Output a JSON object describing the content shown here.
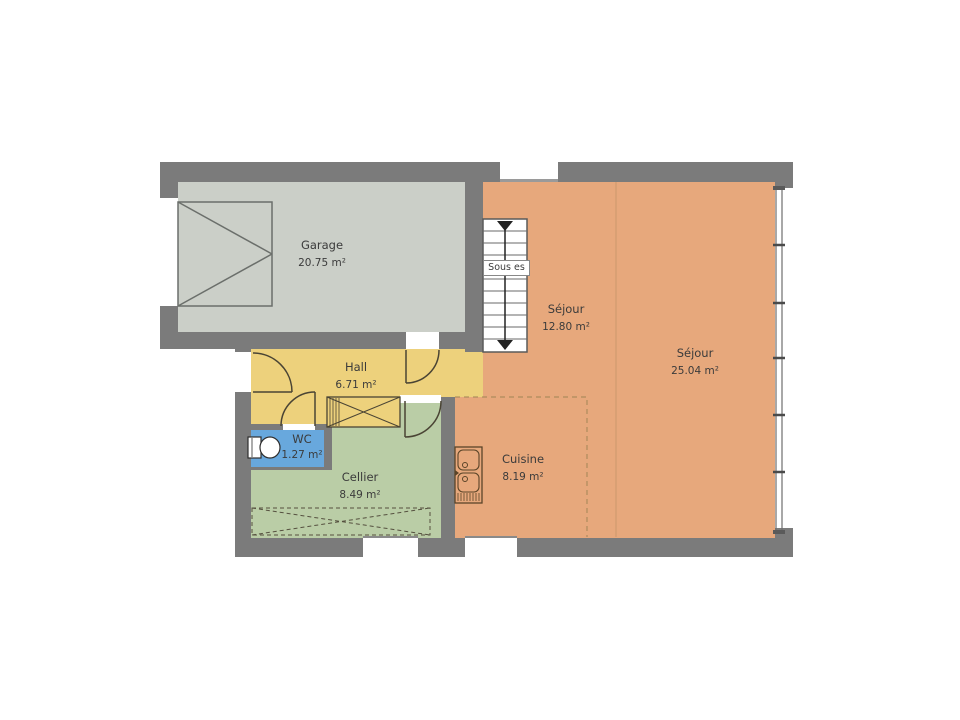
{
  "floor_plan": {
    "rooms": [
      {
        "name": "Garage",
        "area": "20.75 m²",
        "fill": "#cbcfc8"
      },
      {
        "name": "Séjour",
        "area": "12.80 m²",
        "fill": "#e7a87c"
      },
      {
        "name": "Séjour",
        "area": "25.04 m²",
        "fill": "#e7a87c"
      },
      {
        "name": "Hall",
        "area": "6.71 m²",
        "fill": "#edd17c"
      },
      {
        "name": "WC",
        "area": "1.27 m²",
        "fill": "#68a8dd"
      },
      {
        "name": "Cellier",
        "area": "8.49 m²",
        "fill": "#bacda6"
      },
      {
        "name": "Cuisine",
        "area": "8.19 m²",
        "fill": "#e7a87c"
      }
    ],
    "stair_label": "Sous es",
    "colors": {
      "wall": "#7b7b7b",
      "symbol_outline": "#4a4434",
      "background": "#ffffff"
    }
  }
}
